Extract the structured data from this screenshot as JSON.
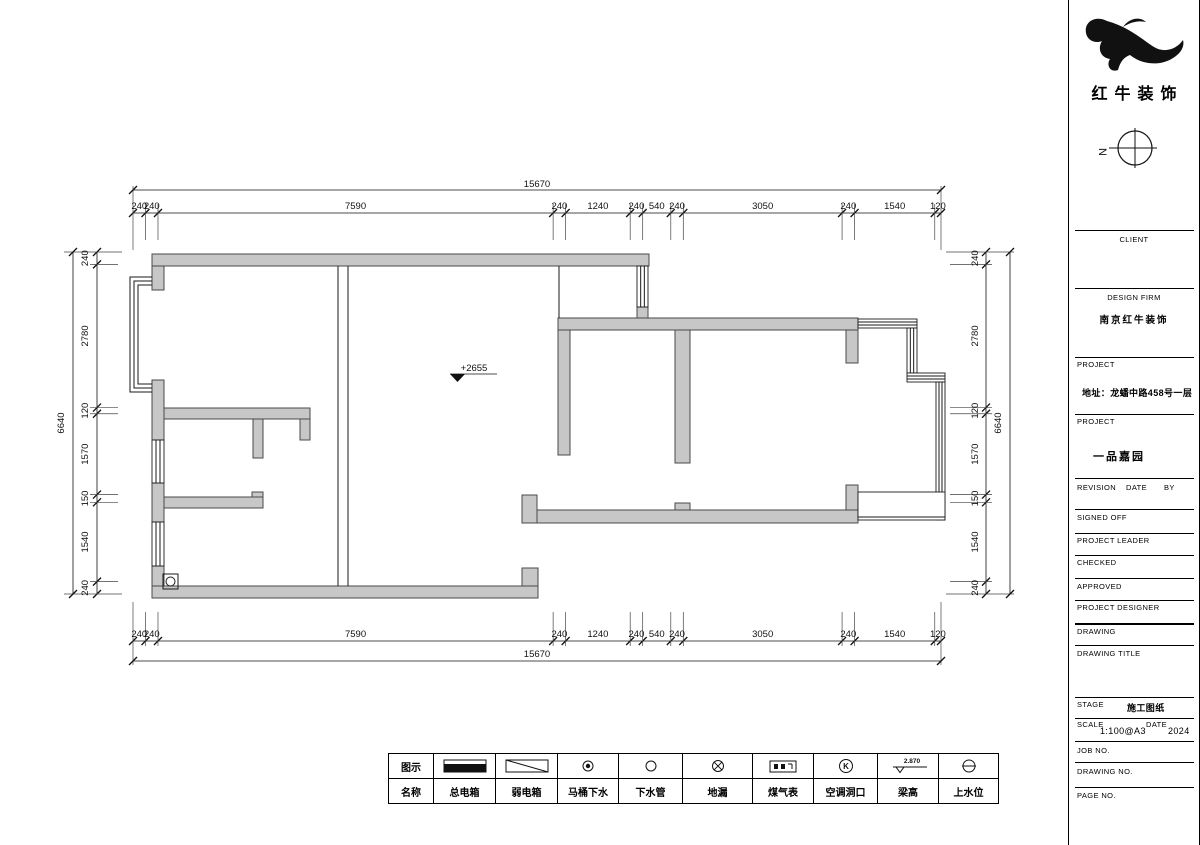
{
  "colors": {
    "wall_fill": "#c7c7c7",
    "line": "#1a1a1a"
  },
  "compass": {
    "north_label": "N"
  },
  "dims": {
    "top": {
      "overall": "15670",
      "segments": [
        "240",
        "240",
        "7590",
        "240",
        "1240",
        "240",
        "540",
        "240",
        "3050",
        "240",
        "1540",
        "120"
      ]
    },
    "bottom": {
      "overall": "15670",
      "segments": [
        "240",
        "240",
        "7590",
        "240",
        "1240",
        "240",
        "540",
        "240",
        "3050",
        "240",
        "1540",
        "120"
      ]
    },
    "left": {
      "overall": "6640",
      "segments": [
        "240",
        "2780",
        "120",
        "1570",
        "150",
        "1540",
        "240"
      ]
    },
    "right": {
      "overall": "6640",
      "segments": [
        "240",
        "2780",
        "120",
        "1570",
        "150",
        "1540",
        "240"
      ]
    }
  },
  "plan": {
    "level_mark": "+2655",
    "walls": [
      [
        152,
        254,
        497,
        12
      ],
      [
        152,
        266,
        12,
        24
      ],
      [
        152,
        380,
        12,
        60
      ],
      [
        152,
        483,
        12,
        39
      ],
      [
        152,
        566,
        12,
        32
      ],
      [
        152,
        586,
        386,
        12
      ],
      [
        522,
        568,
        16,
        18
      ],
      [
        164,
        408,
        146,
        11
      ],
      [
        300,
        419,
        10,
        21
      ],
      [
        253,
        419,
        10,
        39
      ],
      [
        164,
        497,
        99,
        11
      ],
      [
        252,
        492,
        11,
        5
      ],
      [
        637,
        307,
        11,
        11
      ],
      [
        558,
        318,
        300,
        12
      ],
      [
        558,
        330,
        12,
        125
      ],
      [
        675,
        330,
        15,
        133
      ],
      [
        846,
        330,
        12,
        33
      ],
      [
        537,
        510,
        321,
        13
      ],
      [
        522,
        495,
        15,
        28
      ],
      [
        675,
        503,
        15,
        7
      ],
      [
        846,
        485,
        12,
        25
      ]
    ],
    "windows": [
      {
        "x": 152,
        "y": 440,
        "w": 12,
        "h": 43,
        "o": "v"
      },
      {
        "x": 152,
        "y": 522,
        "w": 12,
        "h": 44,
        "o": "v"
      },
      {
        "x": 637,
        "y": 266,
        "w": 11,
        "h": 41,
        "o": "v"
      },
      {
        "x": 858,
        "y": 319,
        "w": 59,
        "h": 9,
        "o": "h"
      },
      {
        "x": 907,
        "y": 328,
        "w": 10,
        "h": 45,
        "o": "v"
      },
      {
        "x": 907,
        "y": 373,
        "w": 38,
        "h": 9,
        "o": "h"
      },
      {
        "x": 936,
        "y": 382,
        "w": 9,
        "h": 138,
        "o": "v"
      },
      {
        "x": 858,
        "y": 492,
        "w": 87,
        "h": 28,
        "o": "bay"
      }
    ],
    "bay_window": [
      [
        [
          152,
          277
        ],
        [
          130,
          277
        ],
        [
          130,
          392
        ],
        [
          152,
          392
        ]
      ],
      [
        [
          152,
          281
        ],
        [
          134,
          281
        ],
        [
          134,
          388
        ],
        [
          152,
          388
        ]
      ],
      [
        [
          152,
          285
        ],
        [
          138,
          285
        ],
        [
          138,
          384
        ],
        [
          152,
          384
        ]
      ]
    ],
    "partition_lines": [
      [
        338,
        266,
        338,
        586
      ],
      [
        348,
        266,
        348,
        586
      ],
      [
        559,
        266,
        559,
        318
      ]
    ],
    "drain": {
      "box": [
        163,
        574,
        15,
        15
      ],
      "cx": 170.5,
      "cy": 581.5,
      "r": 4.5
    }
  },
  "legend": {
    "symbol_header": "图示",
    "name_header": "名称",
    "items": [
      {
        "name": "总电箱",
        "symbol": "main-power-box"
      },
      {
        "name": "弱电箱",
        "symbol": "weak-power-box"
      },
      {
        "name": "马桶下水",
        "symbol": "toilet-drain"
      },
      {
        "name": "下水管",
        "symbol": "drain-pipe"
      },
      {
        "name": "地漏",
        "symbol": "floor-drain"
      },
      {
        "name": "煤气表",
        "symbol": "gas-meter"
      },
      {
        "name": "空调洞口",
        "symbol": "ac-opening",
        "glyph": "K"
      },
      {
        "name": "梁高",
        "symbol": "beam-height",
        "value": "2.870"
      },
      {
        "name": "上水位",
        "symbol": "water-supply"
      }
    ]
  },
  "titleblock": {
    "company": "红牛装饰",
    "client_label": "CLIENT",
    "design_firm_label": "DESIGN FIRM",
    "design_firm_value": "南京红牛装饰",
    "project1_label": "PROJECT",
    "project1_value": "地址：龙蟠中路458号一层",
    "project2_label": "PROJECT",
    "project2_value": "一品嘉园",
    "revision_label": "REVISION",
    "date_label": "DATE",
    "by_label": "BY",
    "signed_off_label": "SIGNED OFF",
    "project_leader_label": "PROJECT LEADER",
    "checked_label": "CHECKED",
    "approved_label": "APPROVED",
    "project_designer_label": "PROJECT DESIGNER",
    "drawing_label": "DRAWING",
    "drawing_title_label": "DRAWING TITLE",
    "stage_label": "STAGE",
    "stage_value": "施工图纸",
    "scale_label": "SCALE",
    "scale_value": "1:100@A3",
    "date2_label": "DATE",
    "date2_value": "2024",
    "job_no_label": "JOB NO.",
    "drawing_no_label": "DRAWING NO.",
    "page_no_label": "PAGE NO."
  }
}
